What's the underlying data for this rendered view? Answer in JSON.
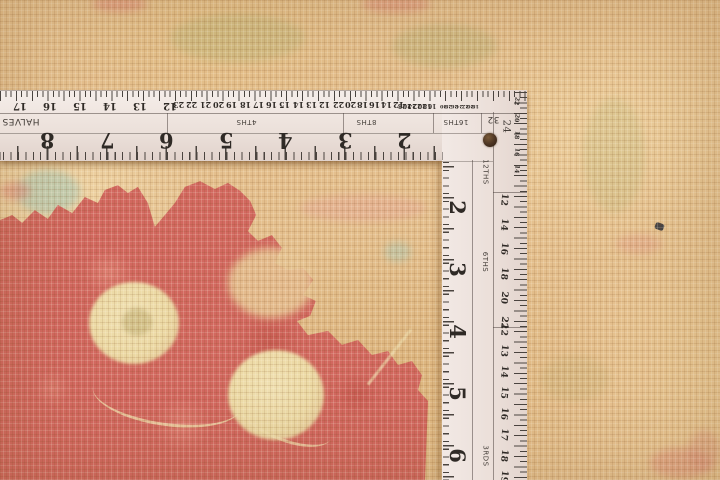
{
  "scene": {
    "subject": "close-up of a tan hand-knotted wool rug with a red floral motif, being measured by an L-shaped white framing-square ruler laid along the top and right edges"
  },
  "carpet": {
    "base_color": "#e4bf8d",
    "weave_light": "#f2ddb0",
    "weave_dark": "#c59a63",
    "red_motif_color": "#d2685f",
    "cream_spot_color": "#ecd9a4",
    "teal_accent_color": "#a9c7b4",
    "olive_accent_color": "#b5b578",
    "pink_accent_color": "#e5a893"
  },
  "ruler": {
    "body_color": "#efe6e1",
    "mark_color": "#3a3531",
    "horizontal_arm": {
      "inch_numbers": [
        "8",
        "7",
        "6",
        "5",
        "4",
        "3",
        "2"
      ],
      "scales": [
        {
          "label": "HALVES",
          "numbers": [
            "17",
            "16",
            "15",
            "14",
            "13",
            "12"
          ]
        },
        {
          "label": "4THS",
          "numbers": [
            "23",
            "22",
            "21",
            "20",
            "19",
            "18",
            "17",
            "16",
            "15",
            "14",
            "13",
            "12"
          ]
        },
        {
          "label": "8THS",
          "numbers": [
            "22",
            "20",
            "18",
            "16",
            "14",
            "12"
          ]
        },
        {
          "label": "16THS",
          "numbers": [
            "28",
            "26",
            "24",
            "22",
            "20",
            "18",
            "16"
          ]
        },
        {
          "label": "32",
          "numbers": [
            "30",
            "28",
            "26",
            "24",
            "22",
            "20",
            "18"
          ]
        }
      ]
    },
    "vertical_arm": {
      "inch_numbers": [
        "2",
        "3",
        "4",
        "5",
        "6"
      ],
      "corner_number": "24",
      "corner_numbers": [
        "22",
        "20",
        "18",
        "16",
        "14"
      ],
      "scales": [
        {
          "label": "12THS"
        },
        {
          "label": "6THS",
          "numbers": [
            "12",
            "14",
            "16",
            "18",
            "20",
            "22"
          ]
        },
        {
          "label": "3RDS",
          "numbers": [
            "12",
            "13",
            "14",
            "15",
            "16",
            "17",
            "18",
            "19"
          ]
        }
      ]
    }
  }
}
